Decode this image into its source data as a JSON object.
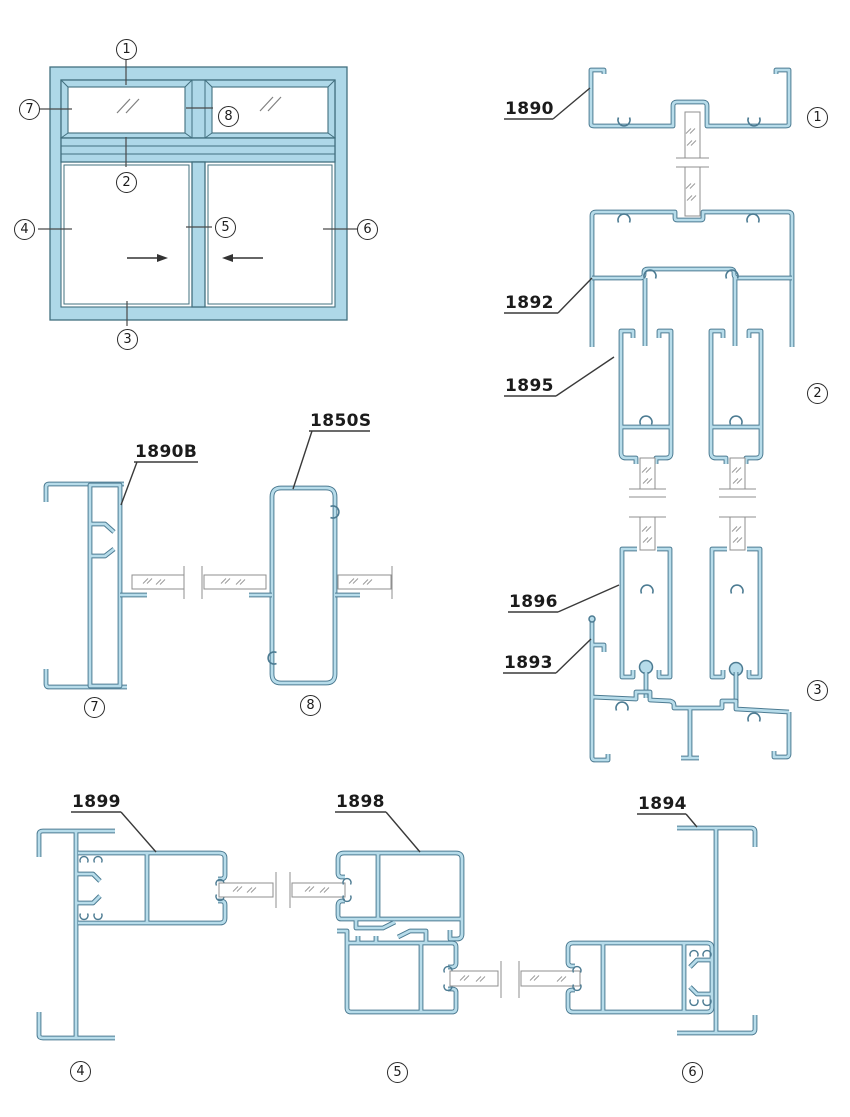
{
  "title": "Aluminium sliding window profile section diagram",
  "colors": {
    "profile_fill": "#b7dcea",
    "profile_outline": "#4c7b92",
    "elevation_fill": "#aed8e8",
    "line": "#3a3a3a",
    "glass_edge": "#8f8f8f"
  },
  "labels": {
    "p1890": "1890",
    "p1892": "1892",
    "p1895": "1895",
    "p1896": "1896",
    "p1893": "1893",
    "p1890b": "1890B",
    "p1850s": "1850S",
    "p1899": "1899",
    "p1898": "1898",
    "p1894": "1894"
  },
  "callouts": {
    "c1": "1",
    "c2": "2",
    "c3": "3",
    "c4": "4",
    "c5": "5",
    "c6": "6",
    "c7": "7",
    "c8": "8"
  },
  "details": [
    {
      "callout": "1",
      "parts": [
        "1890"
      ]
    },
    {
      "callout": "2",
      "parts": [
        "1892",
        "1895"
      ]
    },
    {
      "callout": "3",
      "parts": [
        "1896",
        "1893"
      ]
    },
    {
      "callout": "4",
      "parts": [
        "1899"
      ]
    },
    {
      "callout": "5",
      "parts": [
        "1898"
      ]
    },
    {
      "callout": "6",
      "parts": [
        "1894"
      ]
    },
    {
      "callout": "7",
      "parts": [
        "1890B"
      ]
    },
    {
      "callout": "8",
      "parts": [
        "1850S"
      ]
    }
  ],
  "elevation": {
    "slide_arrows": [
      "right",
      "left"
    ],
    "glass_marks": true
  }
}
